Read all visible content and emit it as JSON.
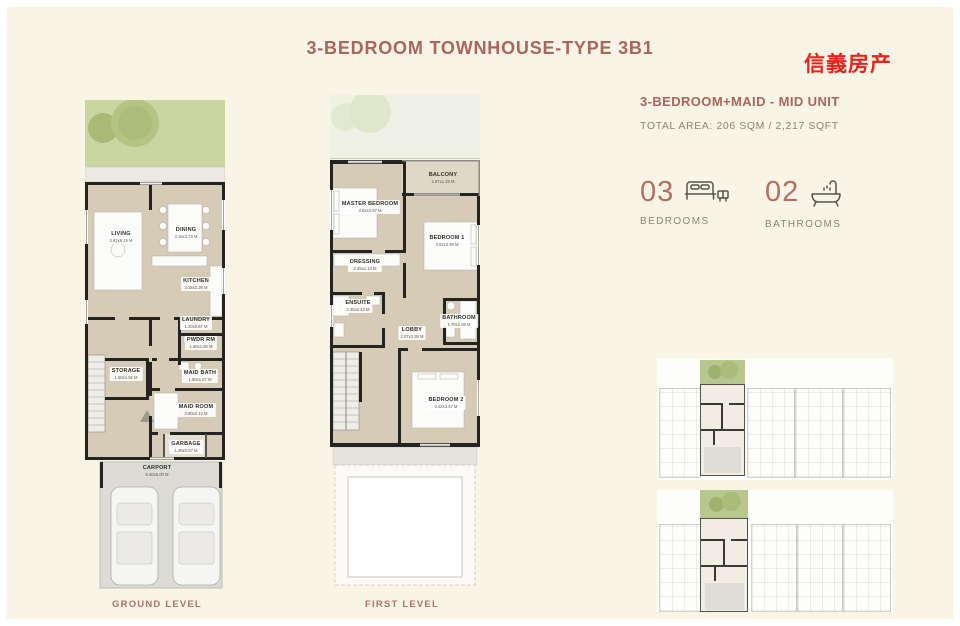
{
  "colors": {
    "accent": "#ab655a",
    "watermark_red": "#e7231b",
    "muted_text": "#8d8372",
    "garden_green": "#cbd5a0",
    "wall_black": "#23231f",
    "floor_tan": "#d6cbb7",
    "page_cream": "#f8f4e6"
  },
  "header": {
    "title": "3-BEDROOM TOWNHOUSE-TYPE 3B1",
    "watermark": "信義房产"
  },
  "info": {
    "unit_type": "3-BEDROOM+MAID - MID UNIT",
    "total_area": "TOTAL AREA: 206 SQM / 2,217 SQFT",
    "stats": [
      {
        "value": "03",
        "label": "BEDROOMS",
        "icon": "bed-icon"
      },
      {
        "value": "02",
        "label": "BATHROOMS",
        "icon": "bathtub-icon"
      }
    ]
  },
  "plans": {
    "ground": {
      "caption": "GROUND LEVEL",
      "rooms": [
        {
          "name": "LIVING",
          "dims": "3.62x6.19 M"
        },
        {
          "name": "DINING",
          "dims": "3.15x2.73 M"
        },
        {
          "name": "KITCHEN",
          "dims": "3.15x2.39 M"
        },
        {
          "name": "LAUNDRY",
          "dims": "1.20x0.67 M"
        },
        {
          "name": "PWDR RM",
          "dims": "1.60x1.80 M"
        },
        {
          "name": "STORAGE",
          "dims": "1.50x1.92 M"
        },
        {
          "name": "MAID BATH",
          "dims": "1.80x1.67 M"
        },
        {
          "name": "MAID ROOM",
          "dims": "3.60x2.12 M"
        },
        {
          "name": "GARBAGE",
          "dims": "1.39x0.57 M"
        },
        {
          "name": "CARPORT",
          "dims": "5.40x5.00 M"
        }
      ]
    },
    "first": {
      "caption": "FIRST LEVEL",
      "rooms": [
        {
          "name": "BALCONY",
          "dims": "2.87x1.45 M"
        },
        {
          "name": "MASTER BEDROOM",
          "dims": "3.62x3.57 M"
        },
        {
          "name": "BEDROOM 1",
          "dims": "3.02x3.49 M"
        },
        {
          "name": "DRESSING",
          "dims": "2.45x1.13 M"
        },
        {
          "name": "ENSUITE",
          "dims": "2.45x2.42 M"
        },
        {
          "name": "BATHROOM",
          "dims": "1.70x2.05 M"
        },
        {
          "name": "LOBBY",
          "dims": "2.07x2.39 M"
        },
        {
          "name": "BEDROOM 2",
          "dims": "3.02x3.47 M"
        }
      ]
    }
  }
}
